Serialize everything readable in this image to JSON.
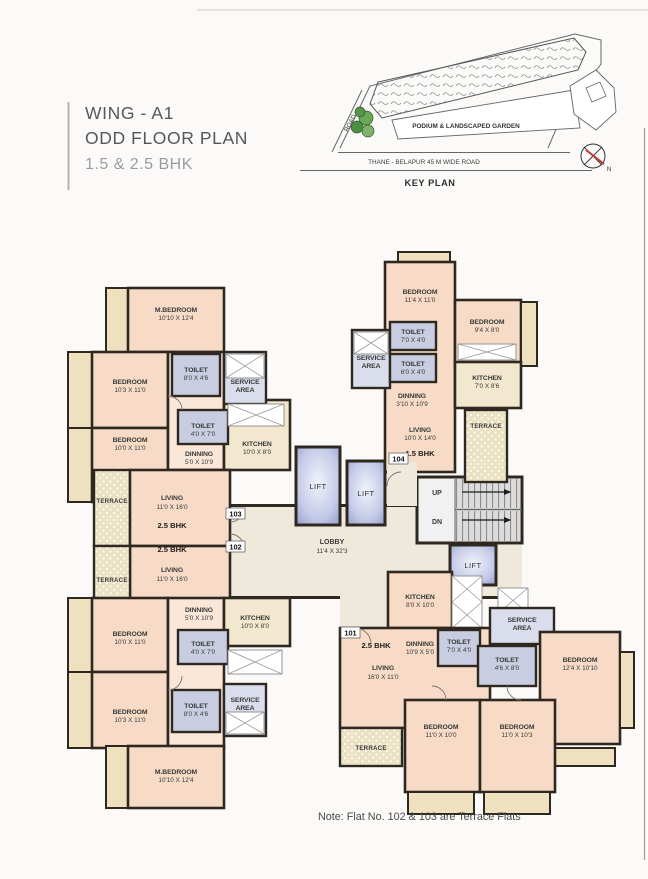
{
  "header": {
    "wing": "WING - A1",
    "floor_plan": "ODD FLOOR PLAN",
    "bhk": "1.5 & 2.5 BHK"
  },
  "key_plan": {
    "podium_label": "PODIUM & LANDSCAPED GARDEN",
    "road_label": "THANE - BELAPUR 45 M WIDE ROAD",
    "title": "KEY PLAN",
    "road_side": "ROAD",
    "north": "N"
  },
  "core": {
    "lift": "LIFT",
    "lobby": "LOBBY",
    "lobby_dims": "11'4 X 32'3",
    "up": "UP",
    "dn": "DN"
  },
  "flats": {
    "f101": {
      "no": "101",
      "type": "2.5 BHK",
      "kitchen": {
        "name": "KITCHEN",
        "dims": "8'0 X 10'0"
      },
      "dining": {
        "name": "DINNING",
        "dims": "10'9 X 5'0"
      },
      "toilet1": {
        "name": "TOILET",
        "dims": "7'0 X 4'0"
      },
      "toilet2": {
        "name": "TOILET",
        "dims": "4'6 X 8'0"
      },
      "service": {
        "l1": "SERVICE",
        "l2": "AREA"
      },
      "living": {
        "name": "LIVING",
        "dims": "16'0 X 11'0"
      },
      "bedroom1": {
        "name": "BEDROOM",
        "dims": "12'4 X 10'10"
      },
      "bedroom2": {
        "name": "BEDROOM",
        "dims": "11'0 X 10'0"
      },
      "bedroom3": {
        "name": "BEDROOM",
        "dims": "11'0 X 10'3"
      },
      "terrace": "TERRACE"
    },
    "f102": {
      "no": "102",
      "type": "2.5 BHK",
      "m_bedroom": {
        "name": "M.BEDROOM",
        "dims": "10'10 X 12'4"
      },
      "bedroom1": {
        "name": "BEDROOM",
        "dims": "10'3 X 11'0"
      },
      "bedroom2": {
        "name": "BEDROOM",
        "dims": "10'0 X 11'0"
      },
      "toilet1": {
        "name": "TOILET",
        "dims": "8'0 X 4'6"
      },
      "toilet2": {
        "name": "TOILET",
        "dims": "4'0 X 7'0"
      },
      "service": {
        "l1": "SERVICE",
        "l2": "AREA"
      },
      "dining": {
        "name": "DINNING",
        "dims": "5'0 X 10'9"
      },
      "kitchen": {
        "name": "KITCHEN",
        "dims": "10'0 X 8'0"
      },
      "living": {
        "name": "LIVING",
        "dims": "11'0 X 16'0"
      },
      "terrace": "TERRACE"
    },
    "f103": {
      "no": "103",
      "type": "2.5 BHK",
      "m_bedroom": {
        "name": "M.BEDROOM",
        "dims": "10'10 X 12'4"
      },
      "bedroom1": {
        "name": "BEDROOM",
        "dims": "10'3 X 11'0"
      },
      "bedroom2": {
        "name": "BEDROOM",
        "dims": "10'0 X 11'0"
      },
      "toilet1": {
        "name": "TOILET",
        "dims": "8'0 X 4'6"
      },
      "toilet2": {
        "name": "TOILET",
        "dims": "4'0 X 7'0"
      },
      "service": {
        "l1": "SERVICE",
        "l2": "AREA"
      },
      "dining": {
        "name": "DINNING",
        "dims": "5'0 X 10'9"
      },
      "kitchen": {
        "name": "KITCHEN",
        "dims": "10'0 X 8'0"
      },
      "living": {
        "name": "LIVING",
        "dims": "11'0 X 16'0"
      },
      "terrace": "TERRACE"
    },
    "f104": {
      "no": "104",
      "type": "1.5 BHK",
      "bedroom1": {
        "name": "BEDROOM",
        "dims": "11'4 X 11'0"
      },
      "bedroom2": {
        "name": "BEDROOM",
        "dims": "9'4 X 8'0"
      },
      "toilet1": {
        "name": "TOILET",
        "dims": "7'0 X 4'0"
      },
      "toilet2": {
        "name": "TOILET",
        "dims": "6'0 X 4'0"
      },
      "service": {
        "l1": "SERVICE",
        "l2": "AREA"
      },
      "kitchen": {
        "name": "KITCHEN",
        "dims": "7'0 X 8'6"
      },
      "dining": {
        "name": "DINNING",
        "dims": "3'10 X 10'9"
      },
      "living": {
        "name": "LIVING",
        "dims": "10'0 X 14'0"
      },
      "terrace": "TERRACE"
    }
  },
  "note": "Note: Flat No. 102 & 103 are Terrace Flats",
  "colors": {
    "wall": "#2f2820",
    "room_peach": "#f7dbc6",
    "room_cream": "#f2e7cf",
    "wet_area": "#c9cde1",
    "terrace": "#ebe1c1",
    "north_needle": "#c03a34",
    "trees": "#5c9a4e"
  }
}
